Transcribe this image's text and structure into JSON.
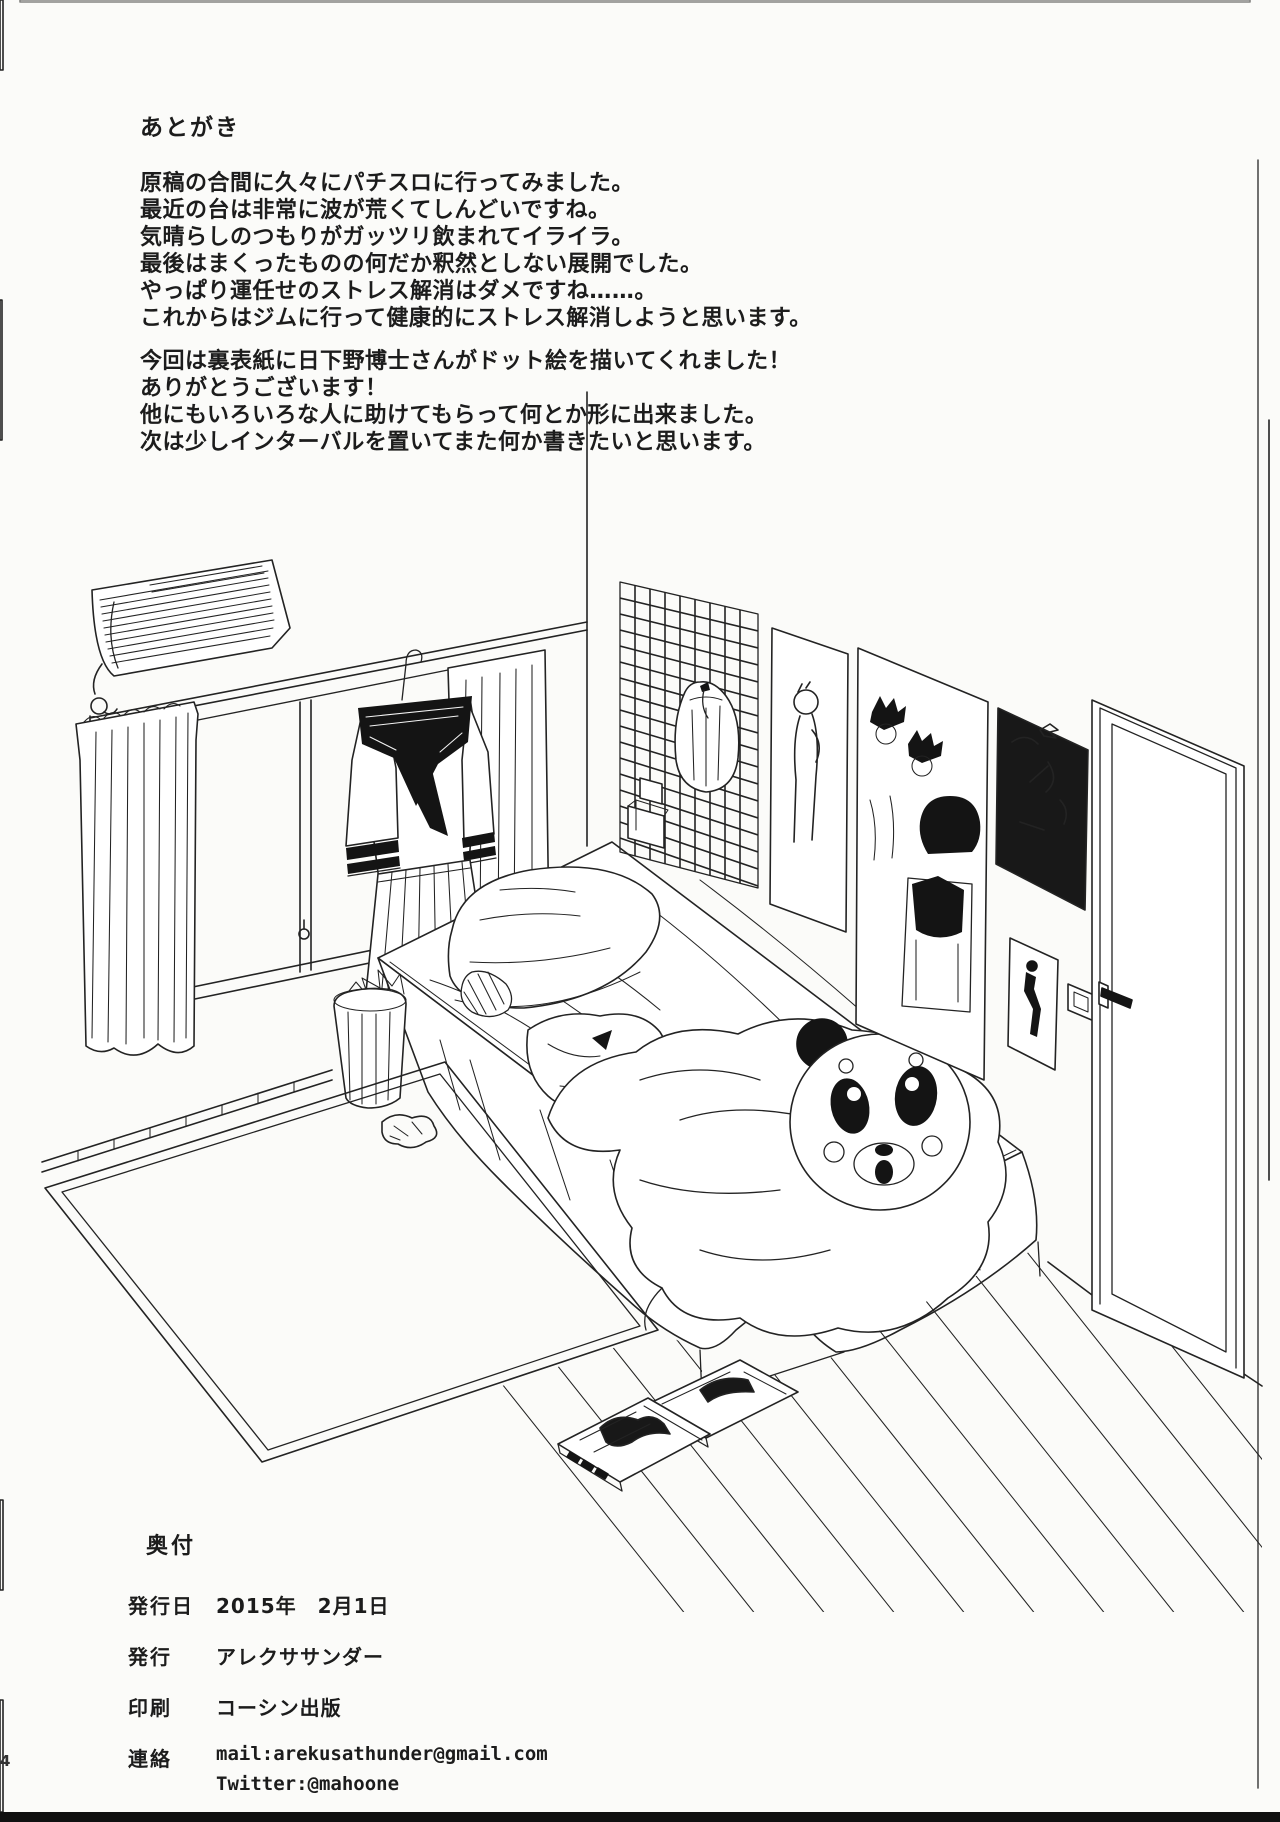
{
  "page": {
    "afterword": {
      "title": "あとがき",
      "paragraph1": [
        "原稿の合間に久々にパチスロに行ってみました。",
        "最近の台は非常に波が荒くてしんどいですね。",
        "気晴らしのつもりがガッツリ飲まれてイライラ。",
        "最後はまくったものの何だか釈然としない展開でした。",
        "やっぱり運任せのストレス解消はダメですね……。",
        "これからはジムに行って健康的にストレス解消しようと思います。"
      ],
      "paragraph2": [
        "今回は裏表紙に日下野博士さんがドット絵を描いてくれました！",
        "ありがとうございます！",
        "他にもいろいろな人に助けてもらって何とか形に出来ました。",
        "次は少しインターバルを置いてまた何か書きたいと思います。"
      ]
    },
    "colophon": {
      "title": "奥付",
      "rows": [
        {
          "label": "発行日",
          "value": "2015年　2月1日"
        },
        {
          "label": "発行",
          "value": "アレクササンダー"
        },
        {
          "label": "印刷",
          "value": "コーシン出版"
        },
        {
          "label": "連絡",
          "value": "mail:arekusathunder@gmail.com",
          "value2": "Twitter:@mahoone"
        }
      ]
    },
    "page_number": "4",
    "illustration": {
      "kind": "monochrome line drawing of a bedroom",
      "elements": "air-conditioner, window, curtains, hanging sailor uniform, wastebasket, bed with pillow and blanket, bear mask, wall grid organizer, posters, door, light switch, tatami mat, wood floor, manga volumes, tissue"
    }
  }
}
